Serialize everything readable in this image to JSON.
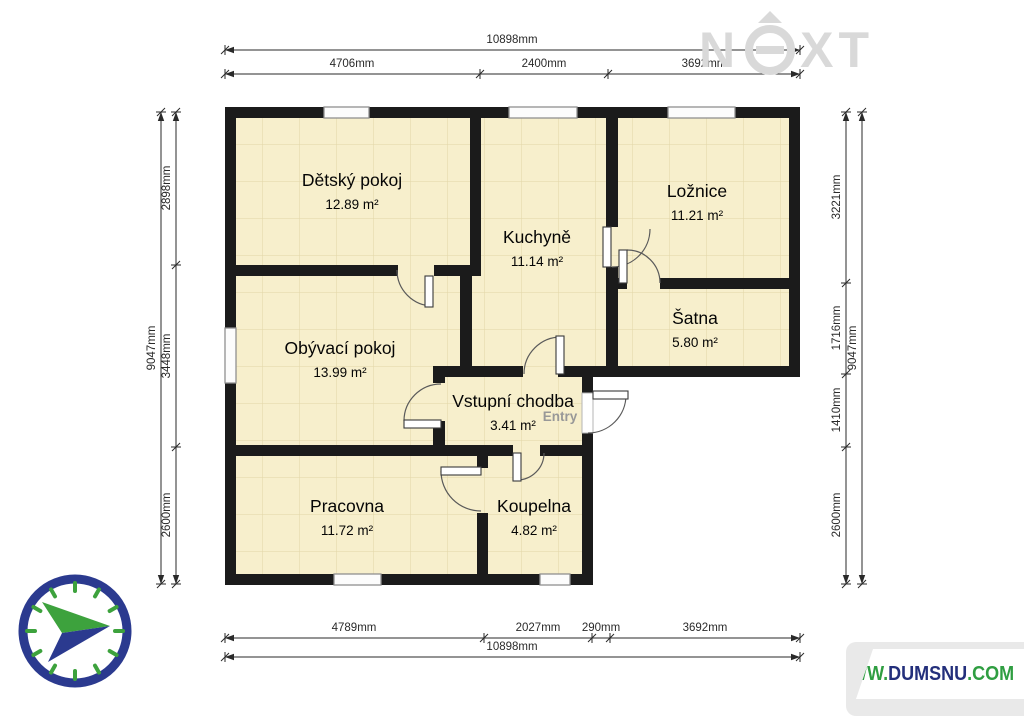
{
  "watermark": {
    "letter_n": "N",
    "letter_x": "X",
    "letter_t": "T",
    "color": "#d9d9d9"
  },
  "website": {
    "www": "WWW.",
    "domain": "DUMSNU",
    "tld": ".COM",
    "green": "#2f9e41",
    "navy": "#232f7b"
  },
  "plan": {
    "wall_color": "#1b1b1b",
    "room_fill": "#f7efcc",
    "grid_color": "#d8c892",
    "footprint": "225,107 800,107 800,377 593,377 593,585 225,585",
    "walls": [
      [
        225,
        107,
        575,
        11
      ],
      [
        225,
        107,
        11,
        478
      ],
      [
        789,
        107,
        11,
        270
      ],
      [
        582,
        366,
        218,
        11
      ],
      [
        582,
        366,
        11,
        27
      ],
      [
        582,
        433,
        11,
        152
      ],
      [
        225,
        574,
        368,
        11
      ],
      [
        470,
        107,
        11,
        169
      ],
      [
        236,
        265,
        162,
        11
      ],
      [
        434,
        265,
        36,
        11
      ],
      [
        460,
        265,
        12,
        112
      ],
      [
        433,
        366,
        90,
        11
      ],
      [
        558,
        366,
        60,
        11
      ],
      [
        433,
        377,
        12,
        6
      ],
      [
        433,
        421,
        12,
        32
      ],
      [
        606,
        107,
        12,
        120
      ],
      [
        606,
        267,
        12,
        99
      ],
      [
        606,
        278,
        21,
        11
      ],
      [
        660,
        278,
        129,
        11
      ],
      [
        225,
        445,
        288,
        11
      ],
      [
        540,
        445,
        53,
        11
      ],
      [
        477,
        456,
        11,
        12
      ],
      [
        477,
        513,
        11,
        61
      ]
    ],
    "windows": [
      [
        324,
        107,
        45,
        11
      ],
      [
        509,
        107,
        68,
        11
      ],
      [
        668,
        107,
        67,
        11
      ],
      [
        225,
        328,
        11,
        55
      ],
      [
        334,
        574,
        47,
        11
      ],
      [
        540,
        574,
        30,
        11
      ]
    ],
    "entry_threshold": [
      582,
      393,
      11,
      40
    ],
    "doors": [
      {
        "leaf": [
          425,
          276,
          8,
          31
        ],
        "arc": "M 397 270 A 36 36 0 0 0 433 306"
      },
      {
        "leaf": [
          404,
          420,
          37,
          8
        ],
        "arc": "M 441 384 A 37 37 0 0 0 404 421"
      },
      {
        "leaf": [
          556,
          336,
          8,
          38
        ],
        "arc": "M 524 374 A 37 37 0 0 1 561 337"
      },
      {
        "leaf": [
          603,
          227,
          8,
          40
        ],
        "arc": "M 612 267 A 38 38 0 0 0 650 229"
      },
      {
        "leaf": [
          619,
          250,
          8,
          33
        ],
        "arc": "M 627 250 A 33 33 0 0 1 660 283"
      },
      {
        "leaf": [
          513,
          453,
          8,
          28
        ],
        "arc": "M 544 453 A 27 27 0 0 1 517 480"
      },
      {
        "leaf": [
          441,
          467,
          40,
          8
        ],
        "arc": "M 441 471 A 40 40 0 0 0 481 511"
      },
      {
        "leaf": [
          593,
          391,
          35,
          8
        ],
        "arc": "M 626 395 A 38 38 0 0 1 588 433"
      }
    ],
    "rooms": [
      {
        "name": "Dětský pokoj",
        "area": "12.89 m²",
        "x": 352,
        "y": 186
      },
      {
        "name": "Kuchyně",
        "area": "11.14 m²",
        "x": 537,
        "y": 243
      },
      {
        "name": "Ložnice",
        "area": "11.21 m²",
        "x": 697,
        "y": 197
      },
      {
        "name": "Šatna",
        "area": "5.80 m²",
        "x": 695,
        "y": 324
      },
      {
        "name": "Obývací pokoj",
        "area": "13.99 m²",
        "x": 340,
        "y": 354
      },
      {
        "name": "Vstupní chodba",
        "area": "3.41 m²",
        "x": 513,
        "y": 407
      },
      {
        "name": "Pracovna",
        "area": "11.72 m²",
        "x": 347,
        "y": 512
      },
      {
        "name": "Koupelna",
        "area": "4.82 m²",
        "x": 534,
        "y": 512
      }
    ],
    "entry_label": {
      "text": "Entry",
      "x": 560,
      "y": 421,
      "color": "#989898"
    }
  },
  "dimensions": {
    "color": "#2a2a2a",
    "horizontal": [
      {
        "y": 50,
        "x1": 225,
        "x2": 800,
        "ticks": [
          225,
          800
        ],
        "labels": [
          {
            "text": "10898mm",
            "x": 512
          }
        ]
      },
      {
        "y": 74,
        "x1": 225,
        "x2": 800,
        "ticks": [
          225,
          480,
          608,
          800
        ],
        "labels": [
          {
            "text": "4706mm",
            "x": 352
          },
          {
            "text": "2400mm",
            "x": 544
          },
          {
            "text": "3692mm",
            "x": 704
          }
        ]
      },
      {
        "y": 638,
        "x1": 225,
        "x2": 800,
        "ticks": [
          225,
          484,
          592,
          610,
          800
        ],
        "labels": [
          {
            "text": "4789mm",
            "x": 354
          },
          {
            "text": "2027mm",
            "x": 538
          },
          {
            "text": "290mm",
            "x": 601
          },
          {
            "text": "3692mm",
            "x": 705
          }
        ]
      },
      {
        "y": 657,
        "x1": 225,
        "x2": 800,
        "ticks": [
          225,
          800
        ],
        "labels": [
          {
            "text": "10898mm",
            "x": 512
          }
        ]
      }
    ],
    "vertical": [
      {
        "x": 161,
        "y1": 112,
        "y2": 584,
        "ticks": [
          112,
          584
        ],
        "labels": [
          {
            "text": "9047mm",
            "y": 348
          }
        ]
      },
      {
        "x": 176,
        "y1": 112,
        "y2": 584,
        "ticks": [
          112,
          265,
          447,
          584
        ],
        "labels": [
          {
            "text": "2898mm",
            "y": 188
          },
          {
            "text": "3448mm",
            "y": 356
          },
          {
            "text": "2600mm",
            "y": 515
          }
        ]
      },
      {
        "x": 846,
        "y1": 112,
        "y2": 584,
        "ticks": [
          112,
          283,
          374,
          447,
          584
        ],
        "labels": [
          {
            "text": "3221mm",
            "y": 197
          },
          {
            "text": "1716mm",
            "y": 328
          },
          {
            "text": "1410mm",
            "y": 410
          },
          {
            "text": "2600mm",
            "y": 515
          }
        ]
      },
      {
        "x": 862,
        "y1": 112,
        "y2": 584,
        "ticks": [
          112,
          584
        ],
        "labels": [
          {
            "text": "9047mm",
            "y": 348
          }
        ]
      }
    ]
  },
  "compass": {
    "cx": 75,
    "cy": 631,
    "r": 52,
    "ring_width": 9,
    "ring_color": "#2b3a8f",
    "tick_color": "#3da23d",
    "arrow_top": "110,626 42,602 62,633",
    "arrow_bottom": "110,626 62,633 48,662"
  }
}
